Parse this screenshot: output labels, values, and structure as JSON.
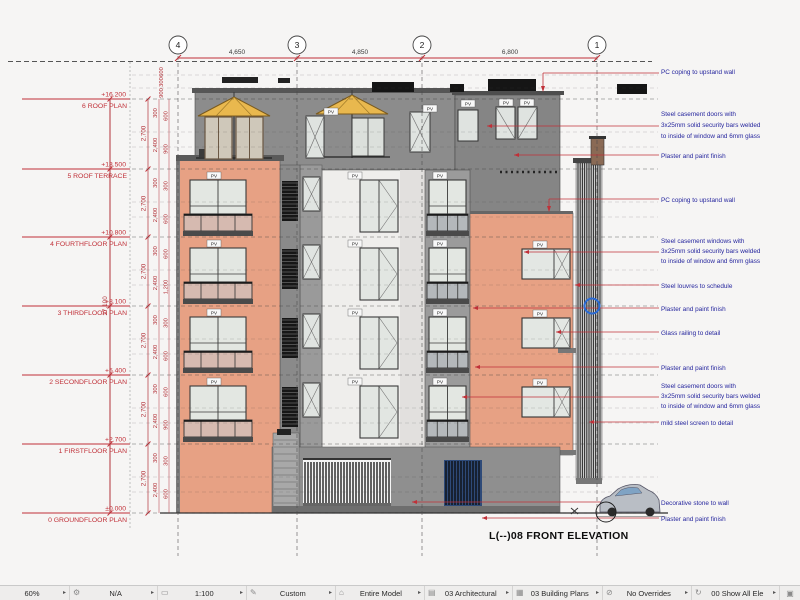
{
  "drawing": {
    "title": "L(--)08 FRONT ELEVATION",
    "pv_label": "PV",
    "grid": {
      "bubbles": [
        "4",
        "3",
        "2",
        "1"
      ],
      "spans": [
        "4,650",
        "4,850",
        "6,800"
      ]
    },
    "levels": [
      {
        "elev": "+16.200",
        "name": "6 ROOF PLAN"
      },
      {
        "elev": "+13.500",
        "name": "5 ROOF TERRACE"
      },
      {
        "elev": "+10.800",
        "name": "4 FOURTHFLOOR PLAN"
      },
      {
        "elev": "+8.100",
        "name": "3 THIRDFLOOR PLAN"
      },
      {
        "elev": "+5.400",
        "name": "2 SECONDFLOOR PLAN"
      },
      {
        "elev": "+2.700",
        "name": "1 FIRSTFLOOR PLAN"
      },
      {
        "elev": "±0.000",
        "name": "0 GROUNDFLOOR PLAN"
      }
    ],
    "dims": {
      "total_height": "17,100",
      "floor_heights": [
        "2,700",
        "2,700",
        "2,700",
        "2,700",
        "2,700",
        "2,700"
      ],
      "sub_a": [
        "300",
        "2,400",
        "300",
        "2,400",
        "300",
        "2,400",
        "300",
        "2,400",
        "300",
        "2,400",
        "300",
        "2,400"
      ],
      "sub_b": [
        "600",
        "900",
        "300",
        "600",
        "600",
        "1,200",
        "300",
        "600",
        "600",
        "900",
        "300",
        "600"
      ],
      "parapet": [
        "600",
        "300",
        "900"
      ]
    },
    "annotations": [
      {
        "lines": [
          "PC coping to upstand wall"
        ]
      },
      {
        "lines": [
          "Steel casement doors with",
          "3x25mm solid security bars welded",
          "to inside of window and 6mm glass"
        ]
      },
      {
        "lines": [
          "Plaster and paint finish"
        ]
      },
      {
        "lines": [
          "PC coping to upstand wall"
        ]
      },
      {
        "lines": [
          "Steel casement windows with",
          "3x25mm solid security bars welded",
          "to inside of window and 6mm glass"
        ]
      },
      {
        "lines": [
          "Steel louvres to schedule"
        ]
      },
      {
        "lines": [
          "Plaster and paint finish"
        ]
      },
      {
        "lines": [
          "Glass railing to detail"
        ]
      },
      {
        "lines": [
          "Plaster and paint finish"
        ]
      },
      {
        "lines": [
          "Steel casement doors with",
          "3x25mm solid security bars welded",
          "to inside of window and 6mm glass"
        ]
      },
      {
        "lines": [
          "mild steel screen to detail"
        ]
      },
      {
        "lines": [
          "Decorative stone to wall"
        ]
      },
      {
        "lines": [
          "Plaster and paint finish"
        ]
      }
    ],
    "colors": {
      "wall_orange": "#e7a184",
      "wall_gray": "#8c8c8c",
      "accent_red": "#c03038",
      "annotation_blue": "#26269e",
      "umbrella_yellow": "#e9b84e"
    }
  },
  "status_bar": {
    "menu_arrow": "▸",
    "trailing_glyph": "▣",
    "items": [
      {
        "icon": "zoom-percent",
        "glyph": "",
        "label": "60%"
      },
      {
        "icon": "orientation",
        "glyph": "⚙",
        "label": "N/A"
      },
      {
        "icon": "scale",
        "glyph": "▭",
        "label": "1:100"
      },
      {
        "icon": "pen-set",
        "glyph": "✎",
        "label": "Custom"
      },
      {
        "icon": "structure-filter",
        "glyph": "⌂",
        "label": "Entire Model"
      },
      {
        "icon": "layer-combination",
        "glyph": "▤",
        "label": "03 Architectural"
      },
      {
        "icon": "model-view-options",
        "glyph": "▦",
        "label": "03 Building Plans"
      },
      {
        "icon": "graphic-overrides",
        "glyph": "⊘",
        "label": "No Overrides"
      },
      {
        "icon": "renovation-filter",
        "glyph": "↻",
        "label": "00 Show All Ele"
      }
    ]
  }
}
